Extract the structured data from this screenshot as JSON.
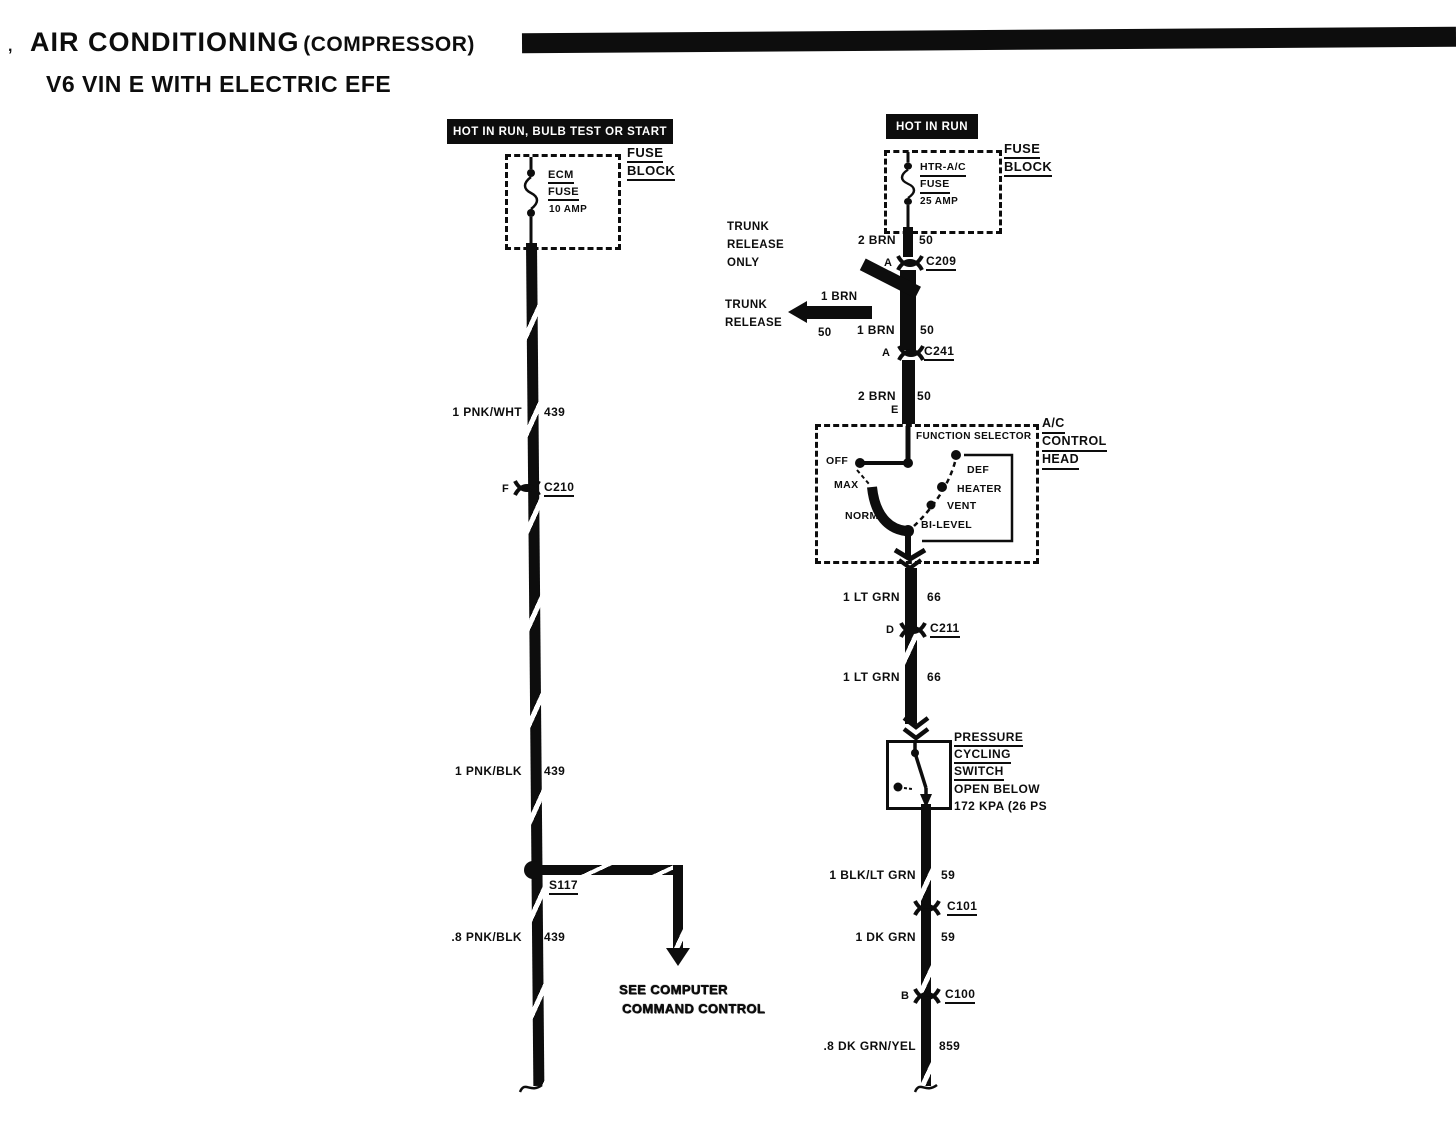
{
  "meta": {
    "ink": "#0d0d0d",
    "paper": "#ffffff"
  },
  "header": {
    "corner_mark": ",",
    "title_main": "AIR CONDITIONING",
    "title_paren": "(COMPRESSOR)",
    "subtitle": "V6 VIN E WITH ELECTRIC EFE"
  },
  "left_circuit": {
    "banner": "HOT IN RUN, BULB TEST OR START",
    "fuse_block_label": {
      "line1": "FUSE",
      "line2": "BLOCK"
    },
    "fuse": {
      "line1": "ECM",
      "line2": "FUSE",
      "rating": "10 AMP"
    },
    "seg1": {
      "gauge": "1 PNK/WHT",
      "circuit": "439"
    },
    "conn_c210": {
      "pin": "F",
      "id": "C210"
    },
    "seg2": {
      "gauge": "1 PNK/BLK",
      "circuit": "439"
    },
    "splice": {
      "id": "S117"
    },
    "seg3": {
      "gauge": ".8 PNK/BLK",
      "circuit": "439"
    },
    "note": {
      "line1": "SEE COMPUTER",
      "line2": "COMMAND CONTROL"
    }
  },
  "right_circuit": {
    "banner": "HOT IN RUN",
    "fuse_block_label": {
      "line1": "FUSE",
      "line2": "BLOCK"
    },
    "fuse": {
      "line1": "HTR-A/C",
      "line2": "FUSE",
      "rating": "25 AMP"
    },
    "seg1": {
      "gauge": "2 BRN",
      "circuit": "50"
    },
    "conn_c209": {
      "pin": "A",
      "id": "C209"
    },
    "trunk_note": {
      "line1": "TRUNK",
      "line2": "RELEASE",
      "line3": "ONLY"
    },
    "trunk_arrow": {
      "line1": "TRUNK",
      "line2": "RELEASE",
      "gauge": "1 BRN",
      "circuit": "50"
    },
    "seg2": {
      "gauge": "1 BRN",
      "circuit": "50"
    },
    "conn_c241": {
      "pin": "A",
      "id": "C241"
    },
    "seg3": {
      "gauge": "2 BRN",
      "circuit": "50",
      "pin": "E"
    },
    "control_head": {
      "label1": "A/C",
      "label2": "CONTROL",
      "label3": "HEAD",
      "selector_label": "FUNCTION SELECTOR",
      "pos_off": "OFF",
      "pos_max": "MAX",
      "pos_norm": "NORM",
      "pos_bilevel": "BI-LEVEL",
      "pos_vent": "VENT",
      "pos_heater": "HEATER",
      "pos_def": "DEF"
    },
    "seg4": {
      "gauge": "1 LT GRN",
      "circuit": "66"
    },
    "conn_c211": {
      "pin": "D",
      "id": "C211"
    },
    "seg5": {
      "gauge": "1 LT GRN",
      "circuit": "66"
    },
    "pressure_switch": {
      "line1": "PRESSURE",
      "line2": "CYCLING",
      "line3": "SWITCH",
      "line4": "OPEN BELOW",
      "line5": "172 KPA (26 PS"
    },
    "seg6": {
      "gauge": "1 BLK/LT GRN",
      "circuit": "59"
    },
    "conn_c101": {
      "id": "C101"
    },
    "seg7": {
      "gauge": "1 DK GRN",
      "circuit": "59"
    },
    "conn_c100": {
      "pin": "B",
      "id": "C100"
    },
    "seg8": {
      "gauge": ".8 DK GRN/YEL",
      "circuit": "859"
    }
  }
}
